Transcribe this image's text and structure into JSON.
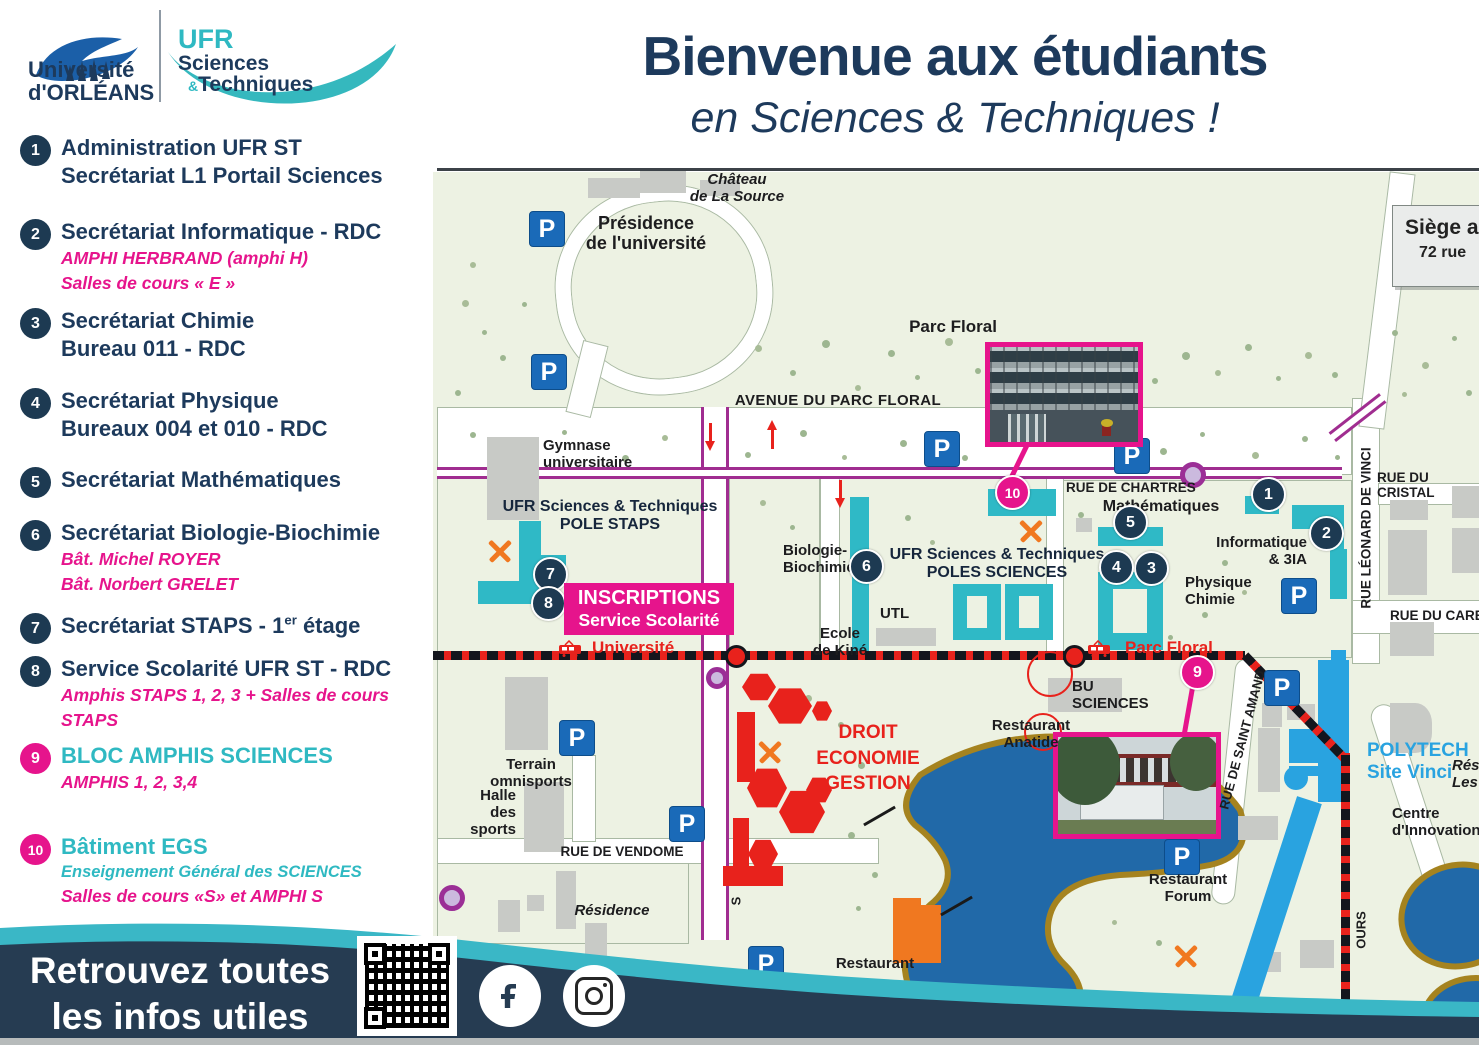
{
  "colors": {
    "navy": "#1d3a5c",
    "teal": "#2fb9c2",
    "pink": "#e6148c",
    "map_green": "#edf2e3",
    "building_teal": "#2fb9c6",
    "building_gray": "#c8cac6",
    "building_red": "#e8221c",
    "polytech_blue": "#29a3e0",
    "lake_blue": "#2169a8",
    "lake_shore": "#a5831f",
    "road_magenta": "#a02d90",
    "parking_blue": "#1a6ab8",
    "tram_red": "#e8221c",
    "footer_navy": "#263c52",
    "footer_teal": "#3ab7c6"
  },
  "header": {
    "uo_logo_text": "Université\nd'ORLÉANS",
    "ufr_line1": "UFR",
    "ufr_line2": "Sciences",
    "ufr_amp": "&",
    "ufr_line3": "Techniques",
    "title": "Bienvenue aux étudiants",
    "subtitle": "en Sciences & Techniques !"
  },
  "legend": {
    "items": [
      {
        "num": "1",
        "t1": "Administration UFR ST",
        "t2": "Secrétariat L1 Portail Sciences"
      },
      {
        "num": "2",
        "t1": "Secrétariat Informatique - RDC",
        "p1": "AMPHI HERBRAND (amphi H)",
        "p2": "Salles de cours « E »"
      },
      {
        "num": "3",
        "t1": "Secrétariat Chimie",
        "t2": "Bureau 011 - RDC"
      },
      {
        "num": "4",
        "t1": "Secrétariat Physique",
        "t2": "Bureaux 004 et 010 - RDC"
      },
      {
        "num": "5",
        "t1": "Secrétariat Mathématiques"
      },
      {
        "num": "6",
        "t1": "Secrétariat Biologie-Biochimie",
        "p1": "Bât. Michel ROYER",
        "p2": "Bât. Norbert GRELET"
      },
      {
        "num": "7",
        "pre": "Secrétariat STAPS - 1",
        "sup": "er",
        "post": " étage"
      },
      {
        "num": "8",
        "t1": "Service Scolarité UFR ST - RDC",
        "p1": "Amphis STAPS 1, 2, 3 + Salles de cours",
        "p2": "STAPS"
      },
      {
        "num": "9",
        "teal": "BLOC AMPHIS SCIENCES",
        "p1": "AMPHIS 1, 2, 3,4"
      },
      {
        "num": "10",
        "teal": "Bâtiment EGS",
        "tealsub": "Enseignement Général des SCIENCES",
        "p1": "Salles de cours «S» et AMPHI S"
      }
    ]
  },
  "map": {
    "parking_letter": "P",
    "streets": {
      "avenue": "AVENUE DU PARC FLORAL",
      "chartres": "RUE DE CHARTRES",
      "cristal": "RUE DU CRISTAL",
      "leonard": "RUE LÉONARD DE VINCI",
      "carbone": "RUE DU CARBO",
      "vendome": "RUE DE VENDOME",
      "saint_amand": "RUE DE SAINT AMAND",
      "ours": "OURS",
      "s": "S"
    },
    "places": {
      "chateau": "Château\nde La Source",
      "presidence": "Présidence\nde l'université",
      "parc_floral": "Parc Floral",
      "gymnase": "Gymnase\nuniversitaire",
      "pole_staps": "UFR Sciences & Techniques\nPOLE STAPS",
      "biologie": "Biologie-\nBiochimie",
      "ecole_kine": "Ecole\nde Kiné",
      "utl": "UTL",
      "poles_sciences": "UFR Sciences & Techniques\nPOLES SCIENCES",
      "mathematiques": "Mathématiques",
      "physique": "Physique\nChimie",
      "informatique": "Informatique\n& 3IA",
      "terrain": "Terrain\nomnisports",
      "halle": "Halle\ndes\nsports",
      "residence": "Résidence",
      "restaurant": "Restaurant",
      "droit": "DROIT\nECONOMIE\nGESTION",
      "bu": "BU\nSCIENCES",
      "anatide": "Restaurant\nAnatide",
      "forum": "Restaurant\nForum",
      "polytech": "POLYTECH\nSite Vinci",
      "centre": "Centre\nd'Innovation",
      "resi": "Rési\nLes"
    },
    "stops": {
      "universite": "Université",
      "parc_floral": "Parc Floral"
    },
    "inscriptions": {
      "line1": "INSCRIPTIONS",
      "line2": "Service Scolarité"
    },
    "siege": {
      "line1": "Siège a",
      "line2": "72 rue"
    },
    "markers": [
      "1",
      "2",
      "3",
      "4",
      "5",
      "6",
      "7",
      "8",
      "9",
      "10"
    ]
  },
  "footer": {
    "tagline": "Retrouvez toutes\nles infos utiles"
  }
}
